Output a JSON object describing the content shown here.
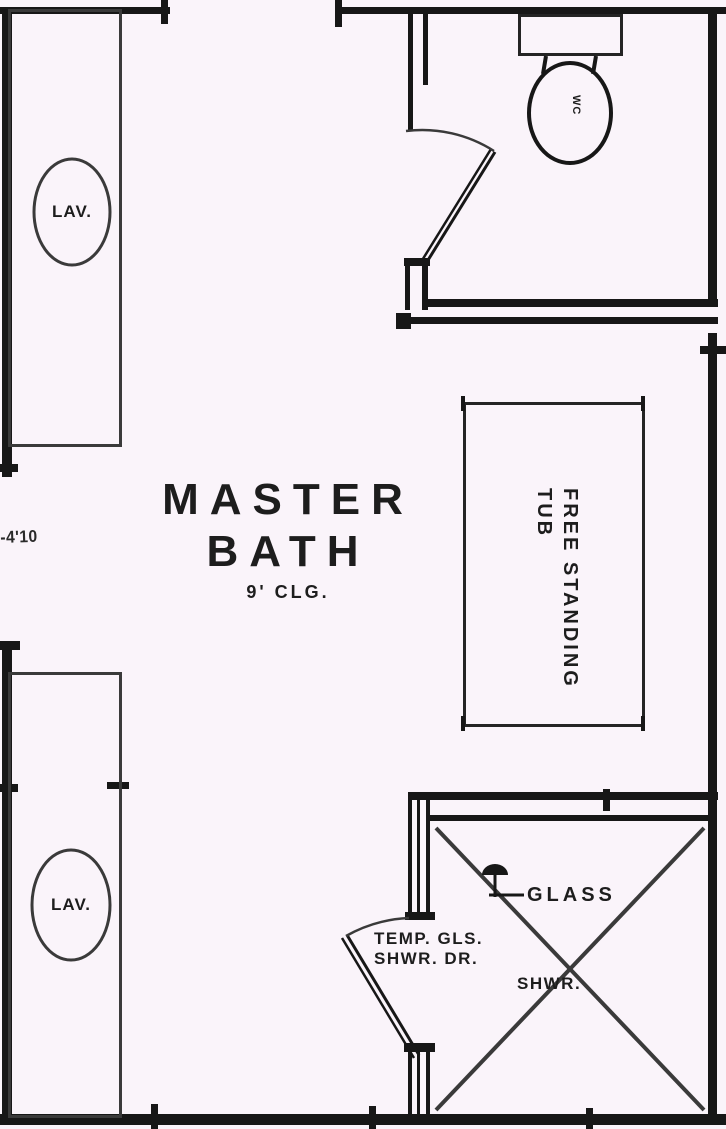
{
  "colors": {
    "background": "#faf4fa",
    "ink": "#171717",
    "line": "#3a3a3a",
    "text": "#1d1d1d"
  },
  "room": {
    "title_line1": "MASTER",
    "title_line2": "BATH",
    "ceiling_note": "9' CLG."
  },
  "fixtures": {
    "lav_top_label": "LAV.",
    "lav_bottom_label": "LAV.",
    "toilet_label": "WC",
    "tub_label_line1": "FREE STANDING",
    "tub_label_line2": "TUB",
    "shower_glass_label": "GLASS",
    "shower_door_label_line1": "TEMP. GLS.",
    "shower_door_label_line2": "SHWR. DR.",
    "shower_label": "SHWR."
  },
  "dimensions": {
    "left_opening": "-4'10"
  }
}
